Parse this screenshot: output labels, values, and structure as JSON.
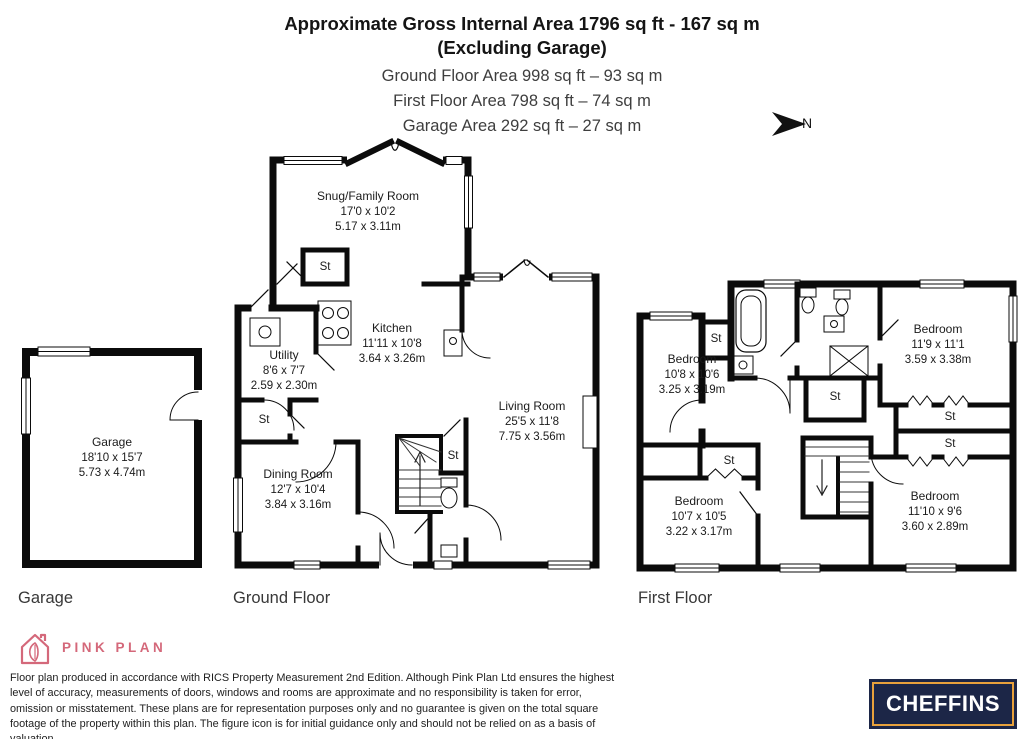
{
  "header": {
    "title_line1": "Approximate Gross Internal Area 1796 sq ft - 167 sq m",
    "title_line2": "(Excluding Garage)",
    "area_lines": [
      "Ground Floor Area 998 sq ft – 93 sq m",
      "First Floor Area 798 sq ft – 74 sq m",
      "Garage Area 292 sq ft – 27 sq m"
    ],
    "north_label": "N"
  },
  "rooms": {
    "garage": {
      "name": "Garage",
      "imperial": "18'10 x 15'7",
      "metric": "5.73 x 4.74m"
    },
    "snug": {
      "name": "Snug/Family Room",
      "imperial": "17'0 x 10'2",
      "metric": "5.17 x 3.11m"
    },
    "kitchen": {
      "name": "Kitchen",
      "imperial": "11'11 x 10'8",
      "metric": "3.64 x 3.26m"
    },
    "utility": {
      "name": "Utility",
      "imperial": "8'6 x 7'7",
      "metric": "2.59 x 2.30m"
    },
    "living": {
      "name": "Living Room",
      "imperial": "25'5 x 11'8",
      "metric": "7.75 x 3.56m"
    },
    "dining": {
      "name": "Dining Room",
      "imperial": "12'7 x 10'4",
      "metric": "3.84 x 3.16m"
    },
    "bedroom_front_left": {
      "name": "Bedroom",
      "imperial": "10'8 x 10'6",
      "metric": "3.25 x 3.19m"
    },
    "bedroom_front_right": {
      "name": "Bedroom",
      "imperial": "11'9 x 11'1",
      "metric": "3.59 x 3.38m"
    },
    "bedroom_back_left": {
      "name": "Bedroom",
      "imperial": "10'7 x 10'5",
      "metric": "3.22 x 3.17m"
    },
    "bedroom_back_right": {
      "name": "Bedroom",
      "imperial": "11'10 x 9'6",
      "metric": "3.60 x 2.89m"
    }
  },
  "storage_label": "St",
  "floor_labels": {
    "garage": "Garage",
    "ground": "Ground Floor",
    "first": "First Floor"
  },
  "branding": {
    "producer_name": "PINK PLAN",
    "agent_name": "CHEFFINS",
    "pink": "#d4687a",
    "navy": "#1c2647",
    "gold": "#e8a13c"
  },
  "disclaimer": "Floor plan produced in accordance with RICS Property Measurement 2nd Edition. Although Pink Plan Ltd ensures the highest level of accuracy, measurements of doors, windows and rooms are approximate and no responsibility is taken for error, omission or misstatement. These plans are for representation purposes only and no guarantee is given on the total square footage of the property within this plan. The figure icon is for initial guidance only and should not be relied on as a basis of valuation."
}
